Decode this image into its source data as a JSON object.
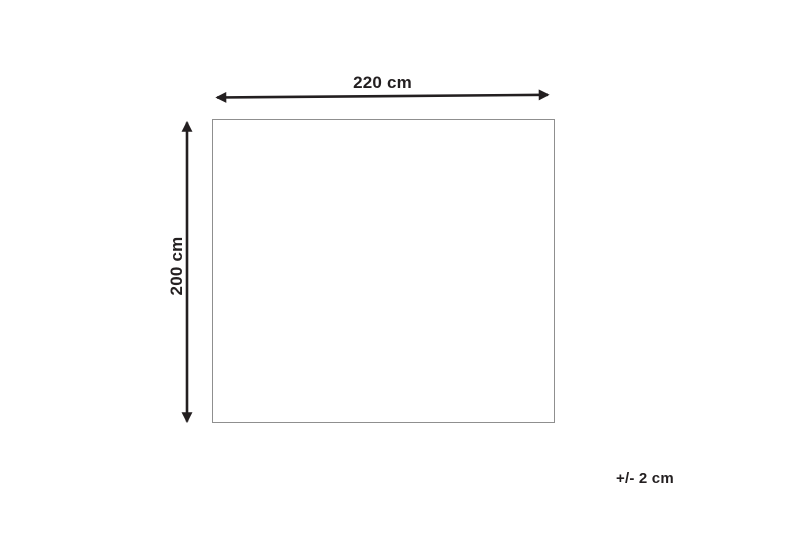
{
  "diagram": {
    "width_arrow_label": "220 cm",
    "height_arrow_label": "200 cm",
    "tolerance_note": "+/- 2 cm"
  },
  "colors": {
    "arrow": "#231f20",
    "text": "#231f20",
    "rect_border": "#8f8f8f",
    "background": "#ffffff"
  }
}
